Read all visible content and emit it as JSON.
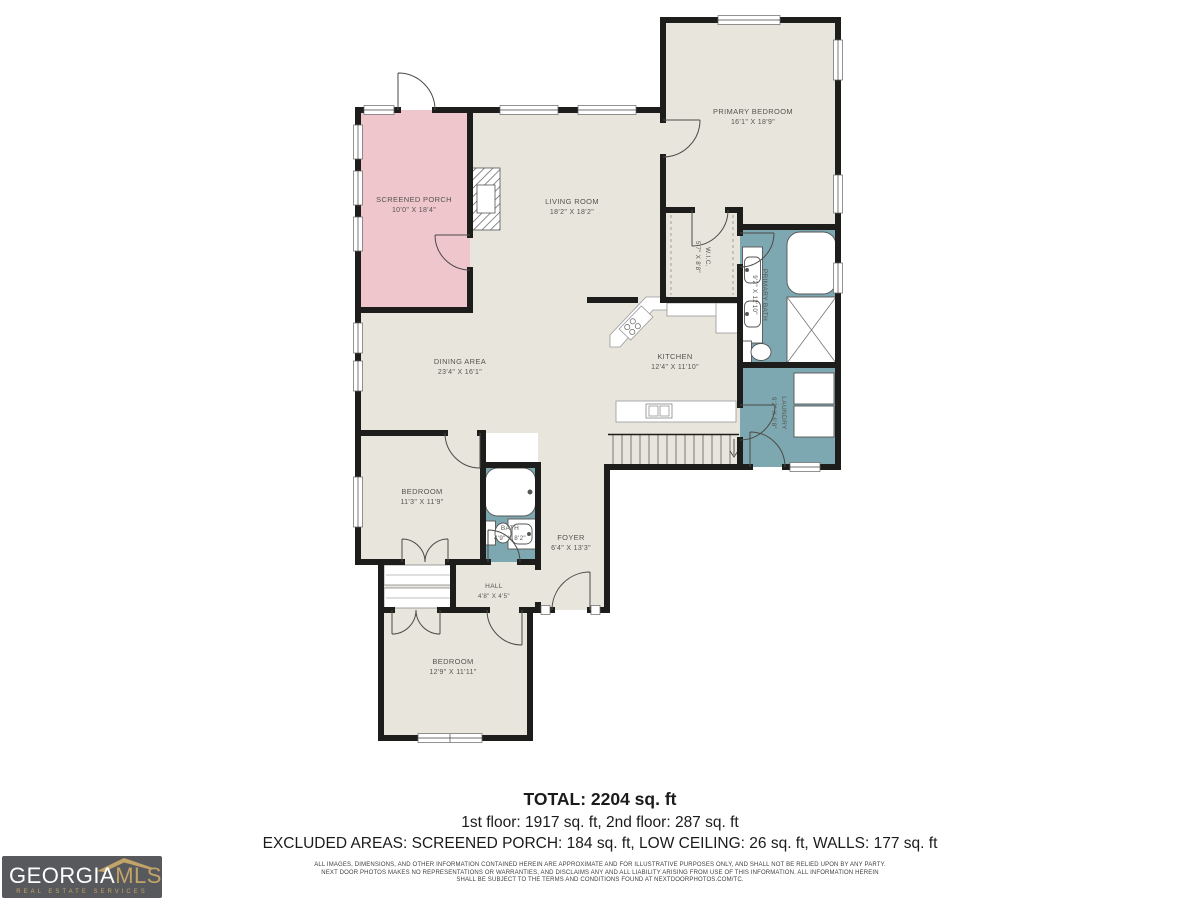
{
  "plan": {
    "rooms": [
      {
        "id": "screened-porch",
        "name": "SCREENED PORCH",
        "dims": "10'0\" X 18'4\""
      },
      {
        "id": "living-room",
        "name": "LIVING ROOM",
        "dims": "18'2\" X 18'2\""
      },
      {
        "id": "primary-bedroom",
        "name": "PRIMARY BEDROOM",
        "dims": "16'1\" X 18'9\""
      },
      {
        "id": "wic",
        "name": "W.I.C.",
        "dims": "5'7\" X 8'8\""
      },
      {
        "id": "primary-bath",
        "name": "PRIMARY BATH",
        "dims": "9'2\" X 12'10\""
      },
      {
        "id": "laundry",
        "name": "LAUNDRY",
        "dims": "9'2\" X 6'8\""
      },
      {
        "id": "dining-area",
        "name": "DINING AREA",
        "dims": "23'4\" X 16'1\""
      },
      {
        "id": "kitchen",
        "name": "KITCHEN",
        "dims": "12'4\" X 11'10\""
      },
      {
        "id": "bedroom-2",
        "name": "BEDROOM",
        "dims": "11'3\" X 11'9\""
      },
      {
        "id": "bath",
        "name": "BATH",
        "dims": "4'9\" X 8'2\""
      },
      {
        "id": "foyer",
        "name": "FOYER",
        "dims": "6'4\" X 13'3\""
      },
      {
        "id": "hall",
        "name": "HALL",
        "dims": "4'8\" X 4'5\""
      },
      {
        "id": "bedroom-3",
        "name": "BEDROOM",
        "dims": "12'9\" X 11'11\""
      }
    ],
    "colors": {
      "floor_beige": "#e8e5dd",
      "porch_pink": "#efc6cb",
      "wet_teal": "#7ea8b1",
      "wall_black": "#1d1d1b"
    }
  },
  "summary": {
    "total": "TOTAL: 2204 sq. ft",
    "floors": "1st floor: 1917 sq. ft, 2nd floor: 287 sq. ft",
    "excluded": "EXCLUDED AREAS: SCREENED PORCH: 184 sq. ft, LOW CEILING: 26 sq. ft, WALLS: 177 sq. ft"
  },
  "disclaimer": {
    "line1": "ALL IMAGES, DIMENSIONS, AND OTHER INFORMATION CONTAINED HEREIN ARE APPROXIMATE AND FOR ILLUSTRATIVE PURPOSES ONLY, AND SHALL NOT BE RELIED UPON BY ANY PARTY.",
    "line2": "NEXT DOOR PHOTOS MAKES NO REPRESENTATIONS OR WARRANTIES, AND DISCLAIMS ANY AND ALL LIABILITY ARISING FROM USE OF THIS INFORMATION. ALL INFORMATION HEREIN",
    "line3": "SHALL BE SUBJECT TO THE TERMS AND CONDITIONS FOUND AT NEXTDOORPHOTOS.COM/TC."
  },
  "logo": {
    "name_primary": "GEORGIA",
    "name_secondary": "MLS",
    "tagline": "REAL ESTATE SERVICES"
  }
}
